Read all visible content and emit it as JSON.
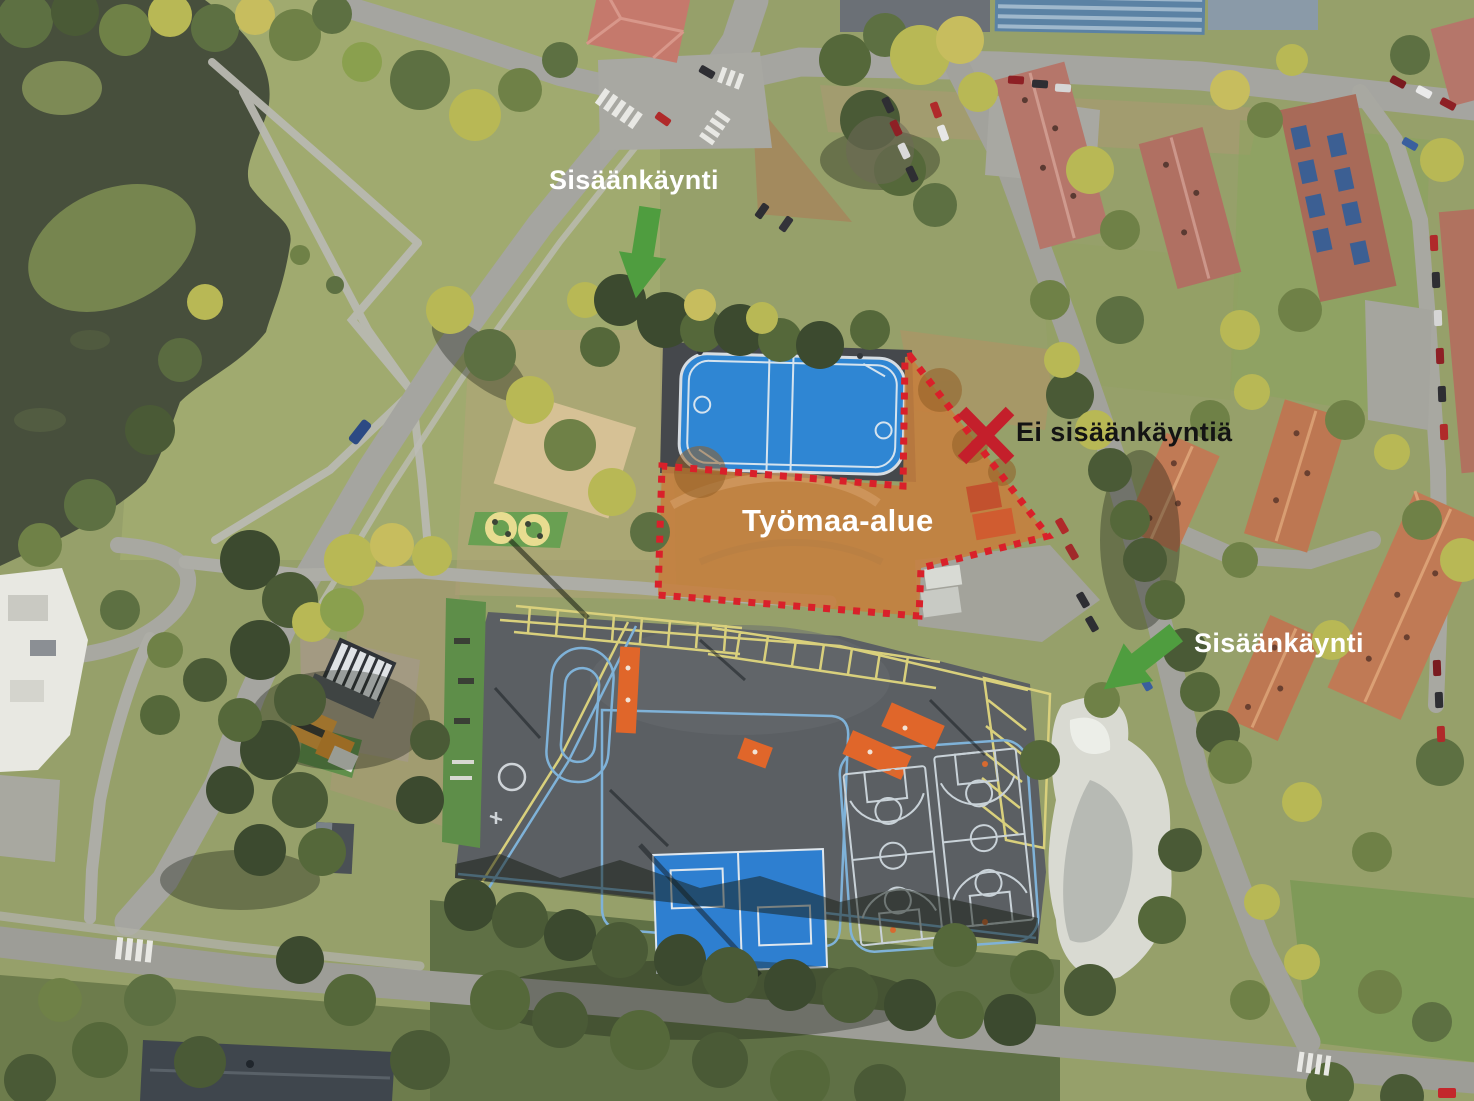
{
  "annotations": {
    "entrance_top": {
      "label": "Sisäänkäynti",
      "color": "#ffffff"
    },
    "no_entrance": {
      "label": "Ei sisäänkäyntiä",
      "color": "#141414"
    },
    "construction_area": {
      "label": "Työmaa-alue",
      "color": "#ffffff"
    },
    "entrance_right": {
      "label": "Sisäänkäynti",
      "color": "#ffffff"
    }
  },
  "colors": {
    "arrow_green": "#4f9d3f",
    "boundary_red": "#d9202a",
    "x_red": "#c41f2b",
    "overlay_orange": "#c67e3d",
    "rink_blue": "#2f86d3",
    "court_blue": "#2e7fd0"
  }
}
